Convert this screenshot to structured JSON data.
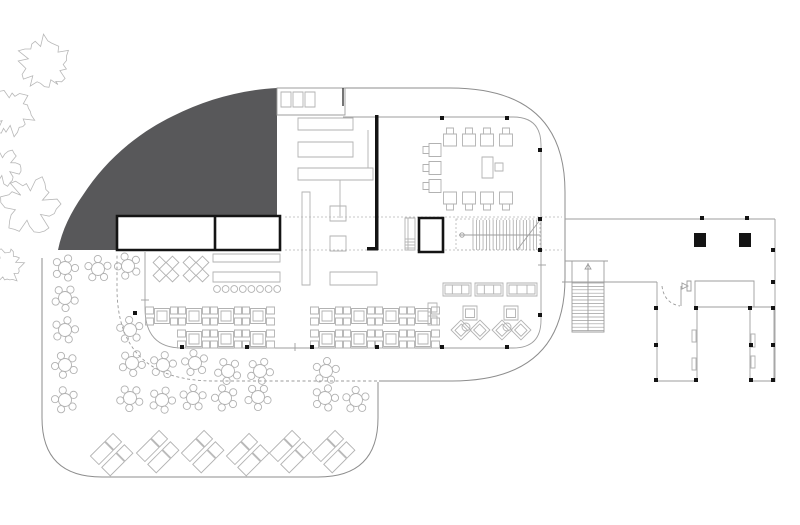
{
  "canvas": {
    "w": 800,
    "h": 525,
    "bg": "#ffffff"
  },
  "colors": {
    "terrain_fill": "#58585a",
    "building_outline": "#8d8d8d",
    "furniture_line": "#b2b2b2",
    "wall_black": "#141414",
    "dash_line": "#9b9b9b",
    "background": "#ffffff"
  },
  "outlines": {
    "terrain_path": "M 277,88 L 277,216 L 117,216 L 117,250 L 58,250 C 62,230 71,212 83,195 C 105,161 136,134 173,116 C 205,100 240,90 277,88 Z",
    "capsule_path": "M 277,88 L 450,88 Q 565,88 565,192 L 565,278 Q 565,381 452,381 L 379,381",
    "terrace_path": "M 378,382 L 378,418 Q 378,477 318,477 L 102,477 Q 42,477 42,418 L 42,258",
    "canopy_dash_path": "M 377,381 L 214,381 Q 117,381 117,288 L 117,253",
    "inner_glass_path": "M 343,117 L 513,117 Q 541,117 541,145 L 541,320 Q 541,348 513,348 L 182,348 Q 145,348 145,308 L 145,252",
    "corridor_dash_lines": [
      [
        285,
        217,
        562,
        217
      ],
      [
        285,
        250,
        562,
        250
      ]
    ],
    "rooms": {
      "x": 117,
      "y": 216,
      "w": 163,
      "h": 34,
      "divider_x": 215
    },
    "strip": {
      "x": 277,
      "y": 88,
      "w": 68,
      "h": 27,
      "cells": [
        [
          281,
          92
        ],
        [
          293,
          92
        ],
        [
          305,
          92
        ]
      ],
      "cell_w": 10,
      "cell_h": 15,
      "stub": [
        343,
        88,
        343,
        106
      ]
    }
  },
  "trees": [
    {
      "cx": 44,
      "cy": 63,
      "r": 28,
      "seed": 1
    },
    {
      "cx": 11,
      "cy": 112,
      "r": 24,
      "seed": 2
    },
    {
      "cx": 3,
      "cy": 167,
      "r": 19,
      "seed": 3
    },
    {
      "cx": 30,
      "cy": 206,
      "r": 30,
      "seed": 4
    },
    {
      "cx": 6,
      "cy": 266,
      "r": 18,
      "seed": 5
    }
  ],
  "kitchen": {
    "counters": [
      [
        298,
        118,
        55,
        12
      ],
      [
        298,
        142,
        55,
        15
      ],
      [
        298,
        168,
        75,
        12
      ],
      [
        302,
        192,
        8,
        93
      ],
      [
        330,
        206,
        16,
        15
      ],
      [
        330,
        236,
        16,
        15
      ]
    ],
    "extra_lines": [
      [
        340,
        180,
        340,
        218
      ],
      [
        368,
        130,
        368,
        168
      ]
    ],
    "black_wall": {
      "rect": [
        375,
        115,
        3.5,
        135
      ],
      "foot": [
        367,
        247,
        11,
        3.5
      ]
    }
  },
  "bar": {
    "back_counter": [
      213,
      254,
      67,
      8
    ],
    "front_counter": [
      213,
      272,
      67,
      10
    ],
    "stools": {
      "y": 289,
      "x_start": 217,
      "step": 8.6,
      "count": 8,
      "r": 3.4
    }
  },
  "buffet_counter": [
    330,
    272,
    47,
    13
  ],
  "benches": [
    [
      443,
      283,
      28,
      13
    ],
    [
      475,
      283,
      28,
      13
    ],
    [
      507,
      283,
      30,
      13
    ]
  ],
  "square_table_rows": [
    {
      "y": 316,
      "xs": [
        162,
        194,
        226,
        258,
        327,
        359,
        391,
        423
      ]
    },
    {
      "y": 339,
      "xs": [
        194,
        226,
        258,
        327,
        359,
        391,
        423
      ]
    }
  ],
  "diamond_groups": [
    [
      166,
      269
    ],
    [
      196,
      269
    ]
  ],
  "round_tables": [
    [
      65,
      268
    ],
    [
      98,
      269
    ],
    [
      128,
      266
    ],
    [
      65,
      298
    ],
    [
      65,
      330
    ],
    [
      130,
      330
    ],
    [
      65,
      365
    ],
    [
      132,
      363
    ],
    [
      163,
      365
    ],
    [
      195,
      363
    ],
    [
      228,
      371
    ],
    [
      260,
      371
    ],
    [
      326,
      371
    ],
    [
      65,
      400
    ],
    [
      130,
      398
    ],
    [
      162,
      400
    ],
    [
      193,
      398
    ],
    [
      225,
      398
    ],
    [
      258,
      397
    ],
    [
      325,
      398
    ],
    [
      356,
      400
    ]
  ],
  "loungers": {
    "pairs": [
      [
        112,
        455
      ],
      [
        158,
        452
      ],
      [
        203,
        452
      ],
      [
        248,
        455
      ],
      [
        291,
        452
      ],
      [
        334,
        452
      ]
    ],
    "rotation": 45
  },
  "lounge_clusters": [
    [
      470,
      313
    ],
    [
      511,
      313
    ]
  ],
  "lounge_side_seats": [
    [
      428,
      303
    ],
    [
      428,
      316
    ]
  ],
  "conference": {
    "top_row": {
      "xs": [
        450,
        469,
        487,
        506
      ],
      "y": 128
    },
    "bottom_row": {
      "xs": [
        450,
        469,
        487,
        506
      ],
      "y": 192
    },
    "left_col": {
      "ys": [
        150,
        168,
        186
      ],
      "x": 423
    },
    "lectern": [
      482,
      157,
      11,
      21
    ],
    "lectern_chair": [
      495,
      163,
      8,
      8
    ]
  },
  "main_stair": {
    "outline": [
      456,
      219,
      84,
      31
    ],
    "tread_x0": 473,
    "tread_x1": 540,
    "tread_step": 3.35,
    "y0": 220,
    "y1": 250,
    "center_y": 235,
    "diag": [
      517,
      250,
      540,
      220
    ]
  },
  "elevator": {
    "rect": [
      419,
      218,
      24,
      34
    ]
  },
  "entry_steps": {
    "rect": [
      405,
      218,
      10,
      32
    ],
    "hatch_ys": [
      239,
      242,
      245,
      248
    ]
  },
  "wing": {
    "lines": [
      [
        565,
        219,
        775,
        219
      ],
      [
        775,
        219,
        775,
        382
      ],
      [
        562,
        282,
        657,
        282
      ],
      [
        565,
        261,
        608,
        261
      ]
    ],
    "stair": {
      "shaft": [
        572,
        261,
        32,
        71
      ],
      "tread_y0": 283,
      "tread_y1": 331,
      "step": 3.4,
      "center_x": 588
    },
    "mid_rect": [
      695,
      281,
      59,
      26
    ],
    "boxA": {
      "left": [
        657,
        282,
        657,
        381
      ],
      "bottom": [
        657,
        381,
        697,
        381
      ],
      "right": [
        697,
        307,
        697,
        381
      ]
    },
    "boxB": [
      750,
      307,
      24,
      74
    ],
    "door": {
      "arc": "M 662,286 Q 664,303 680,306",
      "leaf": [
        681,
        286,
        681,
        306
      ],
      "jamb": [
        687,
        281,
        4,
        10
      ],
      "tri": "688,286 682,283 682,289"
    },
    "slits": [
      [
        692,
        330,
        4,
        12
      ],
      [
        692,
        358,
        4,
        12
      ],
      [
        751,
        334,
        4,
        13
      ],
      [
        751,
        356,
        4,
        12
      ]
    ],
    "big_columns": [
      [
        694,
        233,
        12,
        14
      ],
      [
        739,
        233,
        12,
        14
      ]
    ]
  },
  "columns_small": [
    [
      442,
      118
    ],
    [
      507,
      118
    ],
    [
      540,
      150
    ],
    [
      540,
      219
    ],
    [
      540,
      250
    ],
    [
      540,
      315
    ],
    [
      507,
      347
    ],
    [
      442,
      347
    ],
    [
      377,
      347
    ],
    [
      312,
      347
    ],
    [
      247,
      347
    ],
    [
      182,
      347
    ],
    [
      135,
      313
    ],
    [
      702,
      218
    ],
    [
      747,
      218
    ],
    [
      773,
      250
    ],
    [
      773,
      282
    ],
    [
      656,
      308
    ],
    [
      696,
      308
    ],
    [
      750,
      308
    ],
    [
      773,
      308
    ],
    [
      656,
      345
    ],
    [
      751,
      345
    ],
    [
      773,
      345
    ],
    [
      656,
      380
    ],
    [
      696,
      380
    ],
    [
      751,
      380
    ],
    [
      773,
      380
    ]
  ],
  "ticks": [
    [
      538,
      265,
      546,
      265
    ],
    [
      141,
      300,
      149,
      300
    ],
    [
      295,
      343,
      295,
      351
    ]
  ]
}
